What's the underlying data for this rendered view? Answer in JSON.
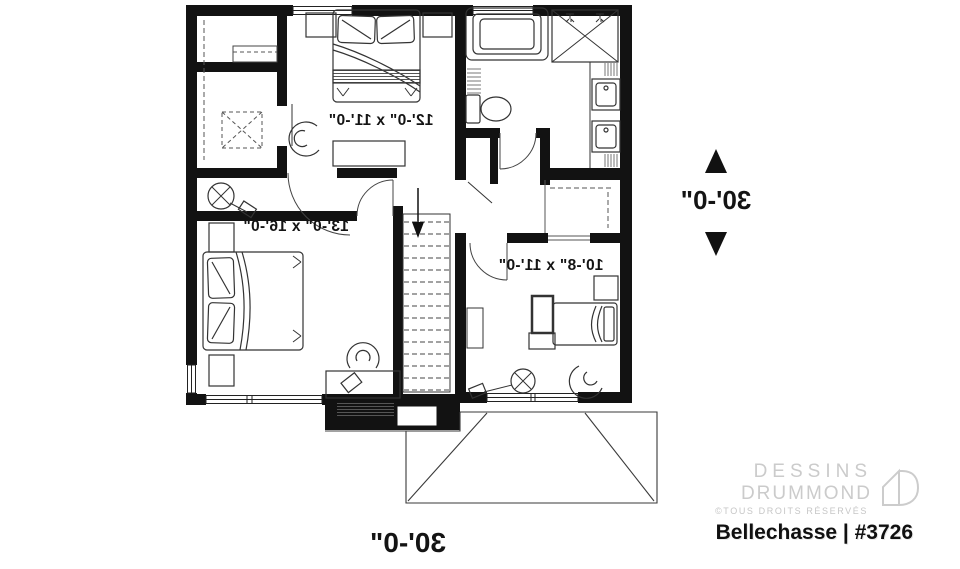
{
  "plan": {
    "rooms": [
      {
        "name": "bedroom",
        "dimensions": "12'-0\" x 11'-0\""
      },
      {
        "name": "master bedroom",
        "dimensions": "13'-0\" x 16'-0\""
      },
      {
        "name": "bedroom",
        "dimensions": "10'-8\" x 11'-0\""
      }
    ],
    "overall": {
      "width": "30'-0\"",
      "depth": "30'-0\""
    }
  },
  "branding": {
    "company_line1": "DESSINS",
    "company_line2": "DRUMMOND",
    "rights_notice": "©TOUS DROITS RÉSERVÉS",
    "plan_title": "Bellechasse | #3726",
    "logo_gray": "#cccccc",
    "ink": "#141414"
  }
}
